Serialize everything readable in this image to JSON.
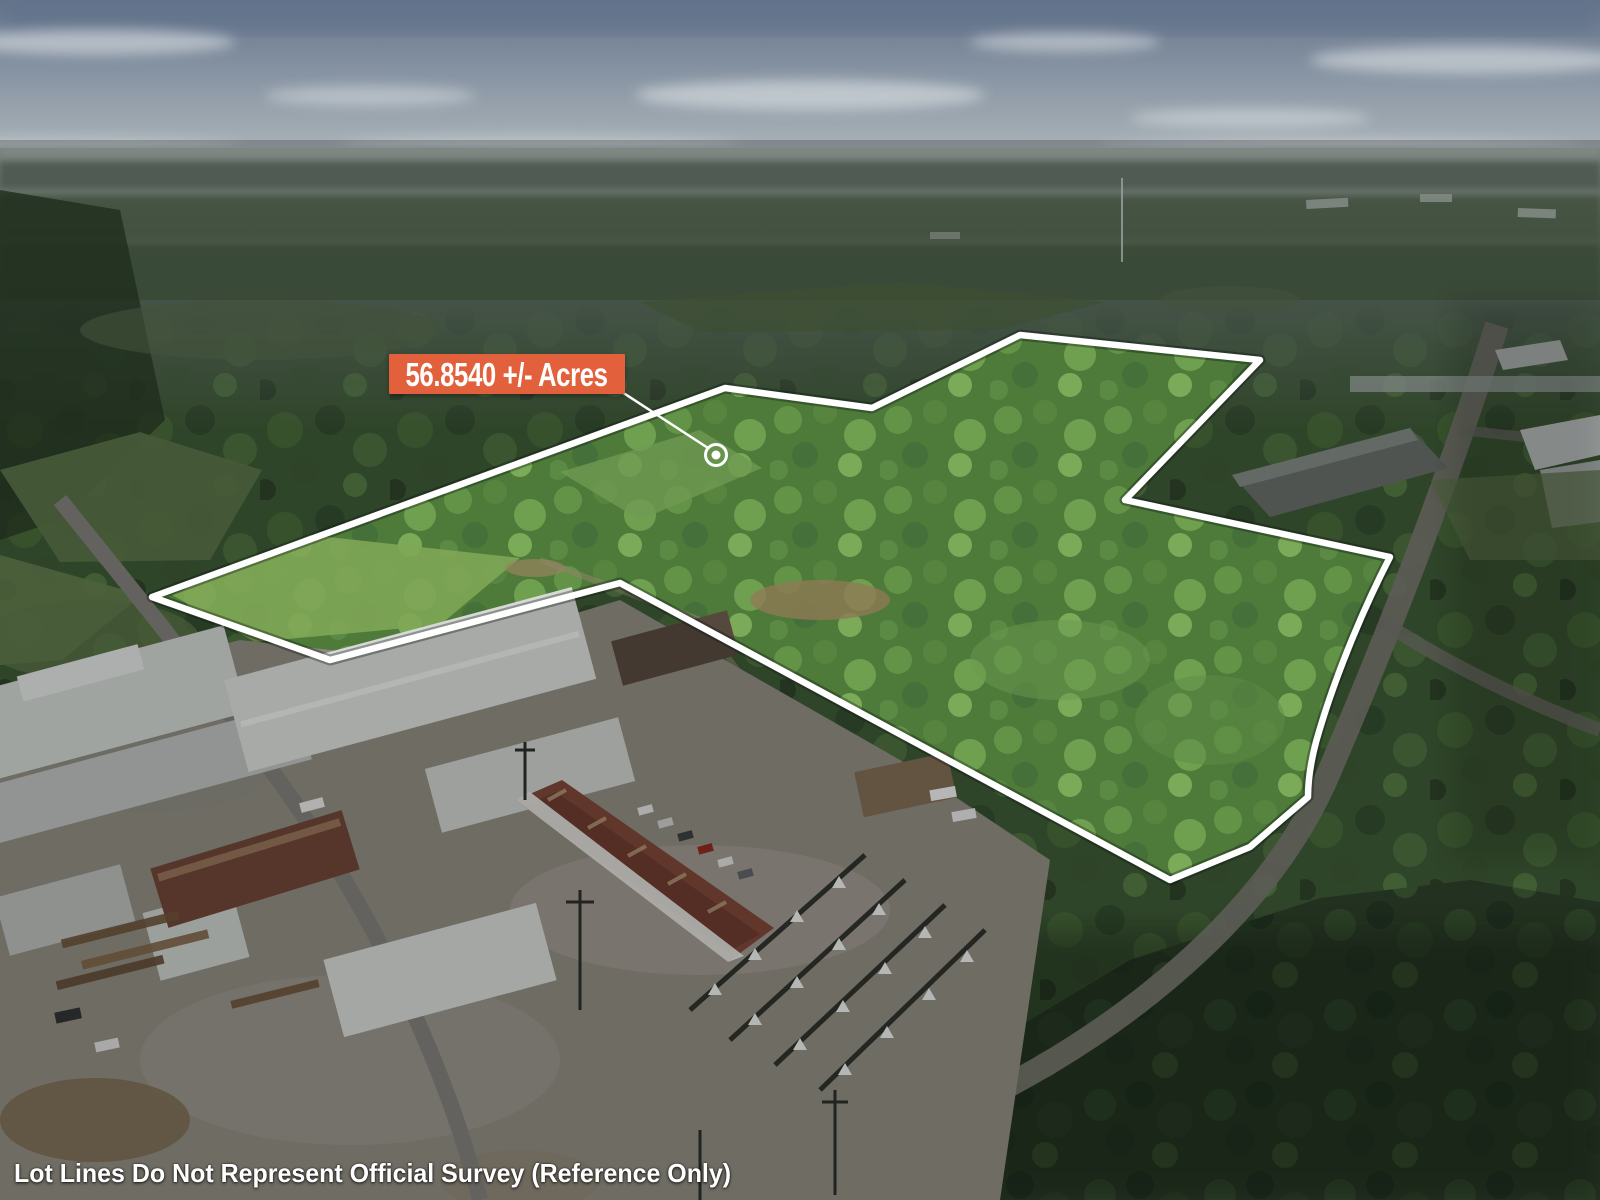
{
  "photo": {
    "description": "Aerial drone photograph of a wooded 56.85 acre parcel outlined in white, bordered by an industrial lumber facility in the foreground and warehouse buildings to the right, forest to the horizon under a hazy blue-grey sky"
  },
  "overlay": {
    "acreage_label": "56.8540 +/- Acres",
    "disclaimer": "Lot Lines Do Not Represent Official Survey (Reference Only)",
    "colors": {
      "label_background": "#e2613c",
      "label_text": "#ffffff",
      "lot_line": "#ffffff",
      "marker_dot": "#ffffff",
      "disclaimer_text": "#ffffff"
    }
  }
}
